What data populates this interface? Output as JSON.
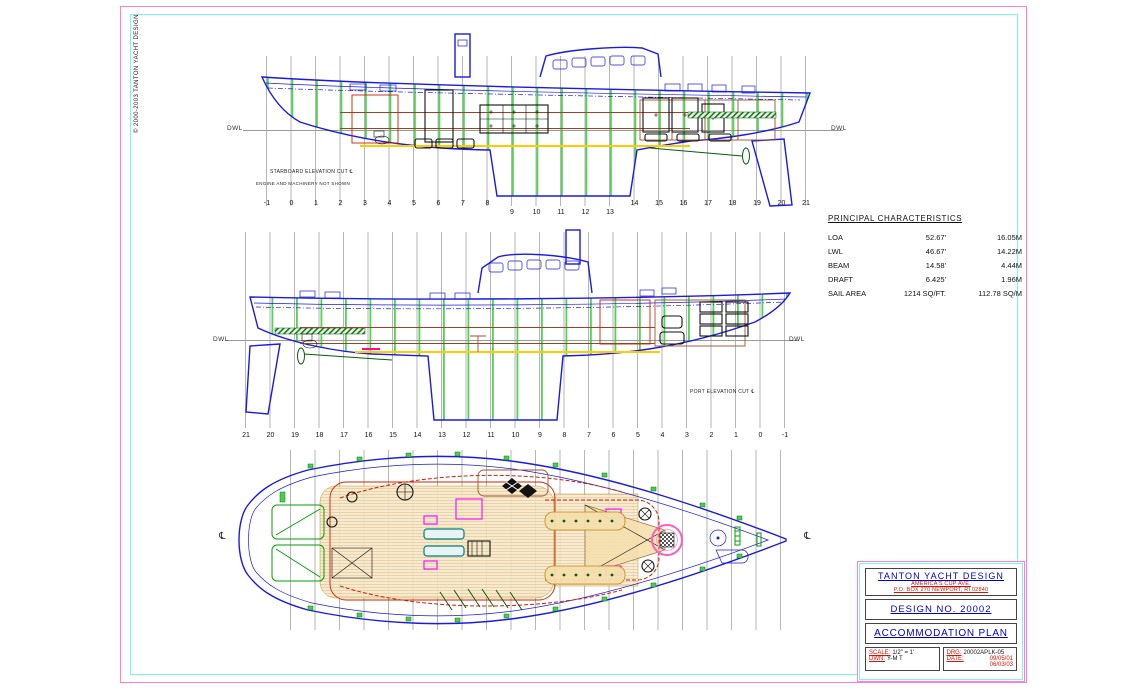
{
  "sheet": {
    "copyright": "© 2000-2003 TANTON YACHT DESIGN"
  },
  "colors": {
    "pink": "#ff7fd4",
    "cyan": "#7df3f3",
    "blue": "#0000cc",
    "red": "#dd1100",
    "blue2": "#1a1ae0",
    "red2": "#cc2200",
    "magenta": "#ff00ff",
    "teal": "#067d7d",
    "yellow": "#ffcc00",
    "tan": "#f8e8c8"
  },
  "characteristics": {
    "title": "PRINCIPAL CHARACTERISTICS",
    "rows": [
      {
        "label": "LOA",
        "ft": "52.67'",
        "m": "16.05M"
      },
      {
        "label": "LWL",
        "ft": "46.67'",
        "m": "14.22M"
      },
      {
        "label": "BEAM",
        "ft": "14.58'",
        "m": "4.44M"
      },
      {
        "label": "DRAFT",
        "ft": "6.425'",
        "m": "1.96M"
      },
      {
        "label": "SAIL AREA",
        "ft": "1214 SQ/FT.",
        "m": "112.78 SQ/M"
      }
    ]
  },
  "views": {
    "starboard": {
      "caption_line1": "STARBOARD ELEVATION CUT ℄",
      "caption_line2": "ENGINE AND MACHINERY NOT SHOWN",
      "dwl_left": "DWL",
      "dwl_right": "DWL",
      "stations": [
        "-1",
        "0",
        "1",
        "2",
        "3",
        "4",
        "5",
        "6",
        "7",
        "8",
        "9",
        "10",
        "11",
        "12",
        "13",
        "14",
        "15",
        "16",
        "17",
        "18",
        "19",
        "20",
        "21"
      ]
    },
    "port": {
      "caption": "PORT ELEVATION CUT ℄",
      "dwl_left": "DWL",
      "dwl_right": "DWL",
      "stations": [
        "21",
        "20",
        "19",
        "18",
        "17",
        "16",
        "15",
        "14",
        "13",
        "12",
        "11",
        "10",
        "9",
        "8",
        "7",
        "6",
        "5",
        "4",
        "3",
        "2",
        "1",
        "0",
        "-1"
      ]
    },
    "plan": {
      "centerline_left": "℄",
      "centerline_right": "℄"
    }
  },
  "title_block": {
    "company": "TANTON YACHT DESIGN",
    "address1": "AMERICA'S CUP AVE.",
    "address2": "P.O. BOX 270 NEWPORT, RI 02840",
    "design_no": "DESIGN NO. 20002",
    "drawing_title": "ACCOMMODATION PLAN",
    "scale_label": "SCALE:",
    "scale_value": "1/2\" = 1'",
    "dwn_label": "DWN:",
    "dwn_value": "Y-M T",
    "drg_label": "DRG:",
    "drg_value": "20002APLK-05",
    "date_label": "DATE:",
    "date_value1": "09/05/01",
    "date_value2": "06/03/03"
  }
}
